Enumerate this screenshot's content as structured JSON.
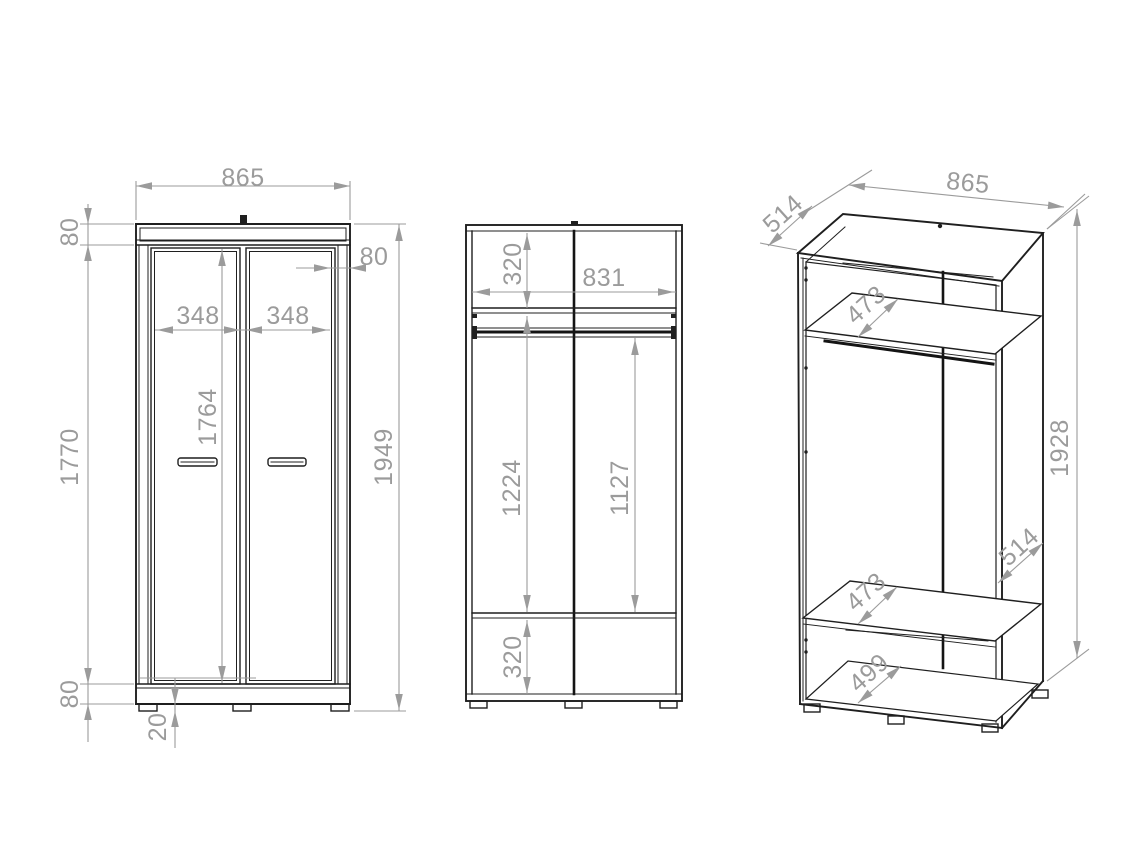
{
  "colors": {
    "background": "#ffffff",
    "object_line": "#1f1f1f",
    "dimension": "#9b9b9b"
  },
  "views": {
    "front": {
      "dimensions": {
        "overall_width": "865",
        "top_panel_height": "80",
        "side_reveal": "80",
        "left_door_width": "348",
        "right_door_width": "348",
        "door_height": "1764",
        "carcass_height": "1770",
        "total_height": "1949",
        "plinth_height": "80",
        "foot_height": "20"
      }
    },
    "interior": {
      "dimensions": {
        "top_section_height": "320",
        "interior_width": "831",
        "left_section_height": "1224",
        "right_section_height": "1127",
        "bottom_section_height": "320"
      }
    },
    "perspective": {
      "dimensions": {
        "top_depth": "514",
        "overall_width": "865",
        "upper_shelf_depth": "473",
        "overall_height": "1928",
        "side_depth": "514",
        "lower_shelf_depth": "473",
        "bottom_depth": "499"
      }
    }
  }
}
